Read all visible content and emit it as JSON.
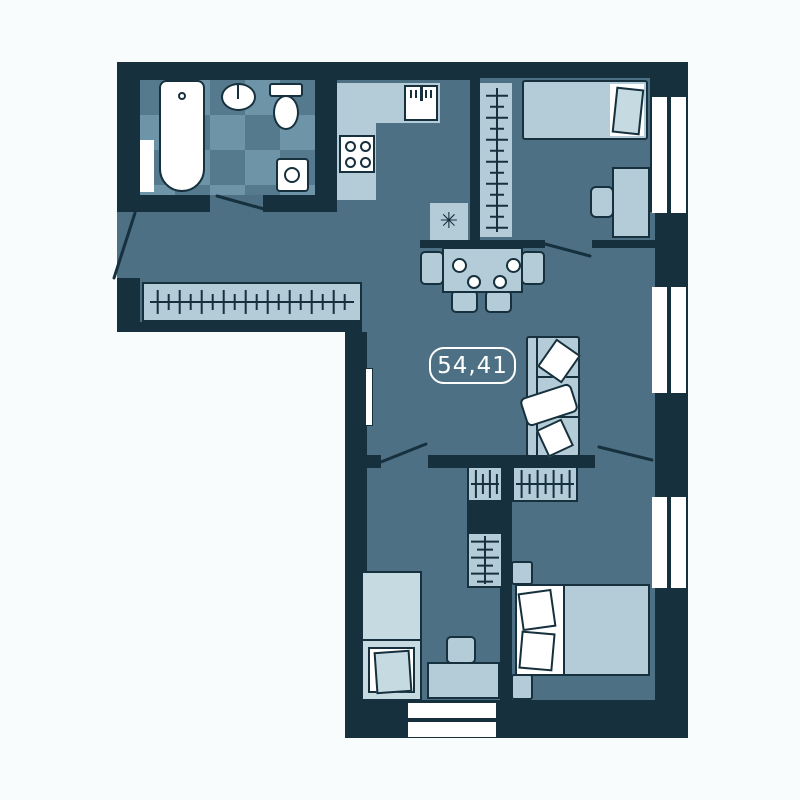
{
  "floor_plan": {
    "area_label": "54,41",
    "heater_symbol": "✳",
    "colors": {
      "background": "#f8fcfc",
      "wall": "#16303d",
      "floor": "#4d7085",
      "tile_light": "#6e94a7",
      "tile_dark": "#557a8e",
      "furniture": "#b3ccd8",
      "furniture_bright": "#c6dae2",
      "fixture": "#ffffff",
      "label_text": "#ffffff"
    }
  }
}
